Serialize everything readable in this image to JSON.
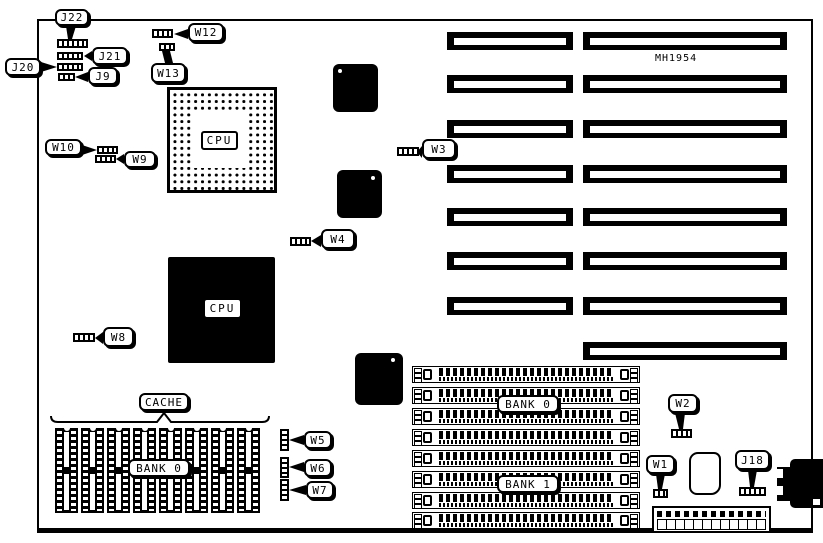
{
  "board": {
    "part_number": "MH1954"
  },
  "labels": {
    "j22": "J22",
    "j21": "J21",
    "j20": "J20",
    "j9": "J9",
    "w12": "W12",
    "w13": "W13",
    "w10": "W10",
    "w9": "W9",
    "w3": "W3",
    "w4": "W4",
    "w8": "W8",
    "w5": "W5",
    "w6": "W6",
    "w7": "W7",
    "w2": "W2",
    "w1": "W1",
    "j18": "J18"
  },
  "components": {
    "cpu_socket_label": "CPU",
    "cpu_chip_label": "CPU",
    "cache_label": "CACHE",
    "cache_bank_label": "BANK 0",
    "memory_bank0_label": "BANK 0",
    "memory_bank1_label": "BANK 1"
  }
}
